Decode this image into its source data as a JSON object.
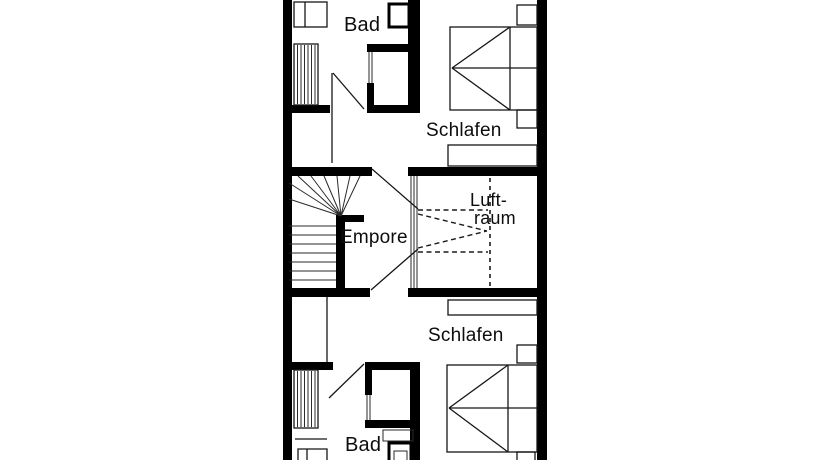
{
  "page": {
    "background": "#ffffff",
    "wall_color": "#000000",
    "line_color": "#161616"
  },
  "floorplan": {
    "type": "floor-plan",
    "language": "de",
    "rooms": [
      {
        "id": "bad-top",
        "label": "Bad"
      },
      {
        "id": "schlafen-top",
        "label": "Schlafen"
      },
      {
        "id": "empore",
        "label": "Empore"
      },
      {
        "id": "luftraum",
        "label": "Luft-raum",
        "label_line1": "Luft-",
        "label_line2": "raum"
      },
      {
        "id": "schlafen-bottom",
        "label": "Schlafen"
      },
      {
        "id": "bad-bottom",
        "label": "Bad"
      }
    ],
    "fixtures": [
      "bed",
      "wardrobe",
      "nightstand",
      "radiator",
      "shower",
      "wc",
      "washbasin",
      "winder-stairs",
      "gallery-railing",
      "void-dashed-marking",
      "door-swing"
    ]
  }
}
